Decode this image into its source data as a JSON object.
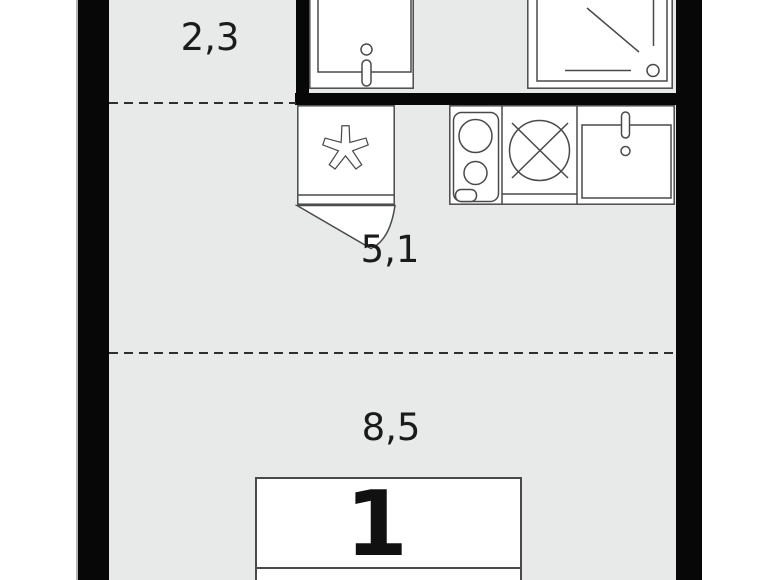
{
  "floorplan": {
    "type": "studio apartment floor plan",
    "unit_label": "1",
    "areas": {
      "hallway": "2,3",
      "kitchen": "5,1",
      "living_room": "8,5"
    },
    "fixtures": {
      "bathroom": [
        "washbasin",
        "shower"
      ],
      "kitchen_row": [
        "washing-machine",
        "hob",
        "stove",
        "kitchen-sink"
      ],
      "living_room": [
        "bed"
      ],
      "symbols": [
        "asterisk-washing-machine-symbol",
        "circle-cross-stove-symbol",
        "door-swing-arc"
      ]
    },
    "colors": {
      "wall": "#070707",
      "floor": "#e8eaea",
      "line": "#4a4a4a",
      "fixture_fill": "#ffffff",
      "dash": "#2e2e2e",
      "label_text": "#1b1b1b",
      "background": "#ffffff"
    }
  }
}
